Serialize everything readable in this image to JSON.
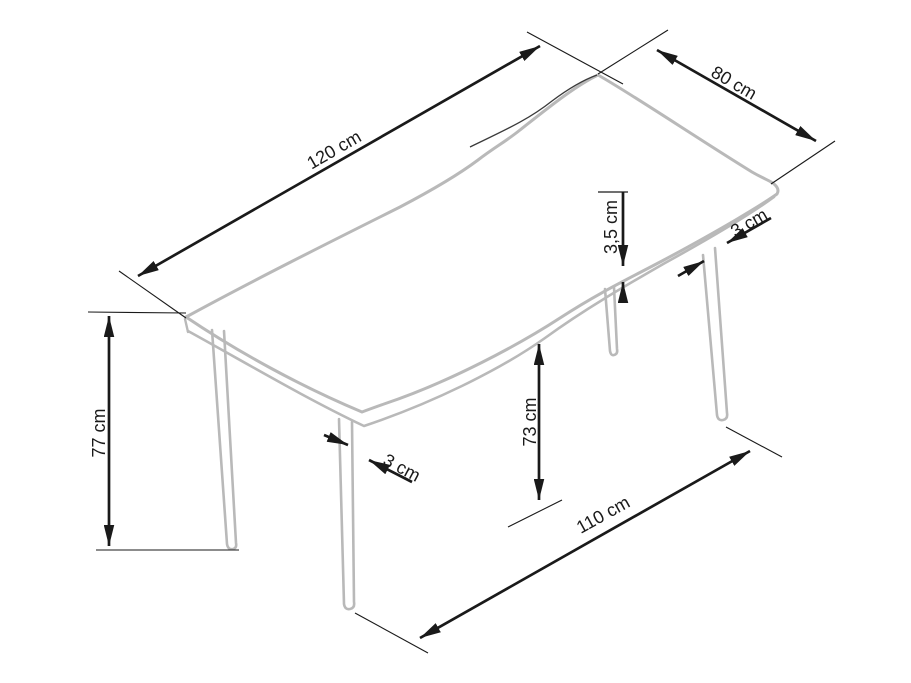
{
  "diagram": {
    "subject": "table-dimension-drawing",
    "background": "#ffffff",
    "dimension_color": "#1a1a1a",
    "furniture_color": "#b9b9b9",
    "edge_detail_color": "#3a3a3a",
    "labels": {
      "top_length": "120 cm",
      "top_width": "80 cm",
      "top_thickness": "3,5 cm",
      "right_leg_width": "3 cm",
      "total_height": "77 cm",
      "front_leg_width": "3 cm",
      "underside_height": "73 cm",
      "leg_span_length": "110 cm"
    }
  }
}
